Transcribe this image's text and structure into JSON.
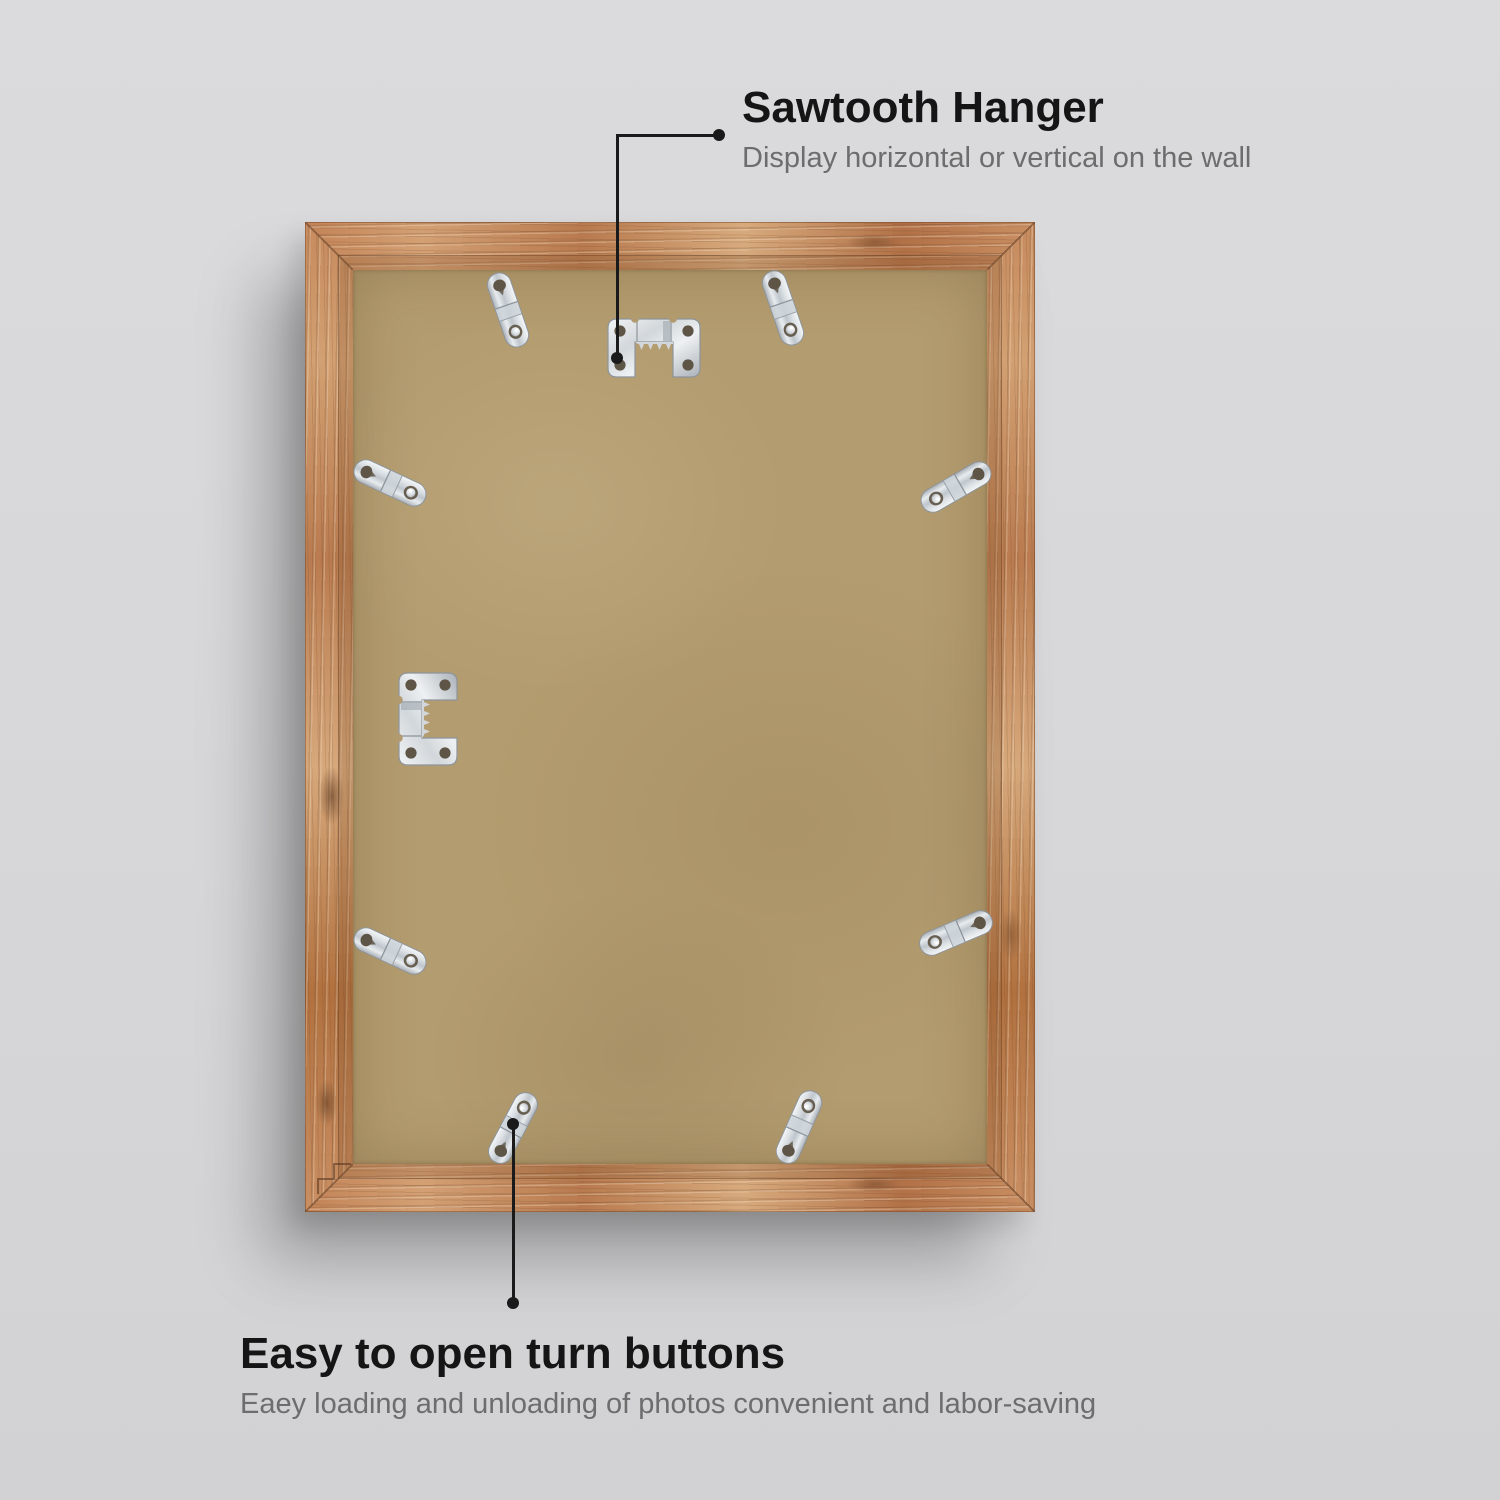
{
  "image_type": "annotated product photo of picture frame back",
  "background_color": "#d7d7d9",
  "annotations": {
    "sawtooth": {
      "title": "Sawtooth Hanger",
      "subtitle": "Display horizontal or vertical on the wall"
    },
    "turn_buttons": {
      "title": "Easy to open turn buttons",
      "subtitle": "Eaey loading and unloading of photos convenient and labor-saving"
    }
  },
  "colors": {
    "wood": "#c28457",
    "backing_board": "#b39c6f",
    "metal_hardware": "#d7dce0",
    "text_primary": "#151515",
    "text_secondary": "#6d6d6d",
    "callout_line": "#1a1a1a",
    "drop_shadow": "rgba(0,0,0,0.27)"
  },
  "hardware": {
    "sawtooth_hanger_count": 2,
    "turn_button_count": 8,
    "icons": [
      "sawtooth-hanger-icon",
      "turn-button-icon"
    ]
  }
}
